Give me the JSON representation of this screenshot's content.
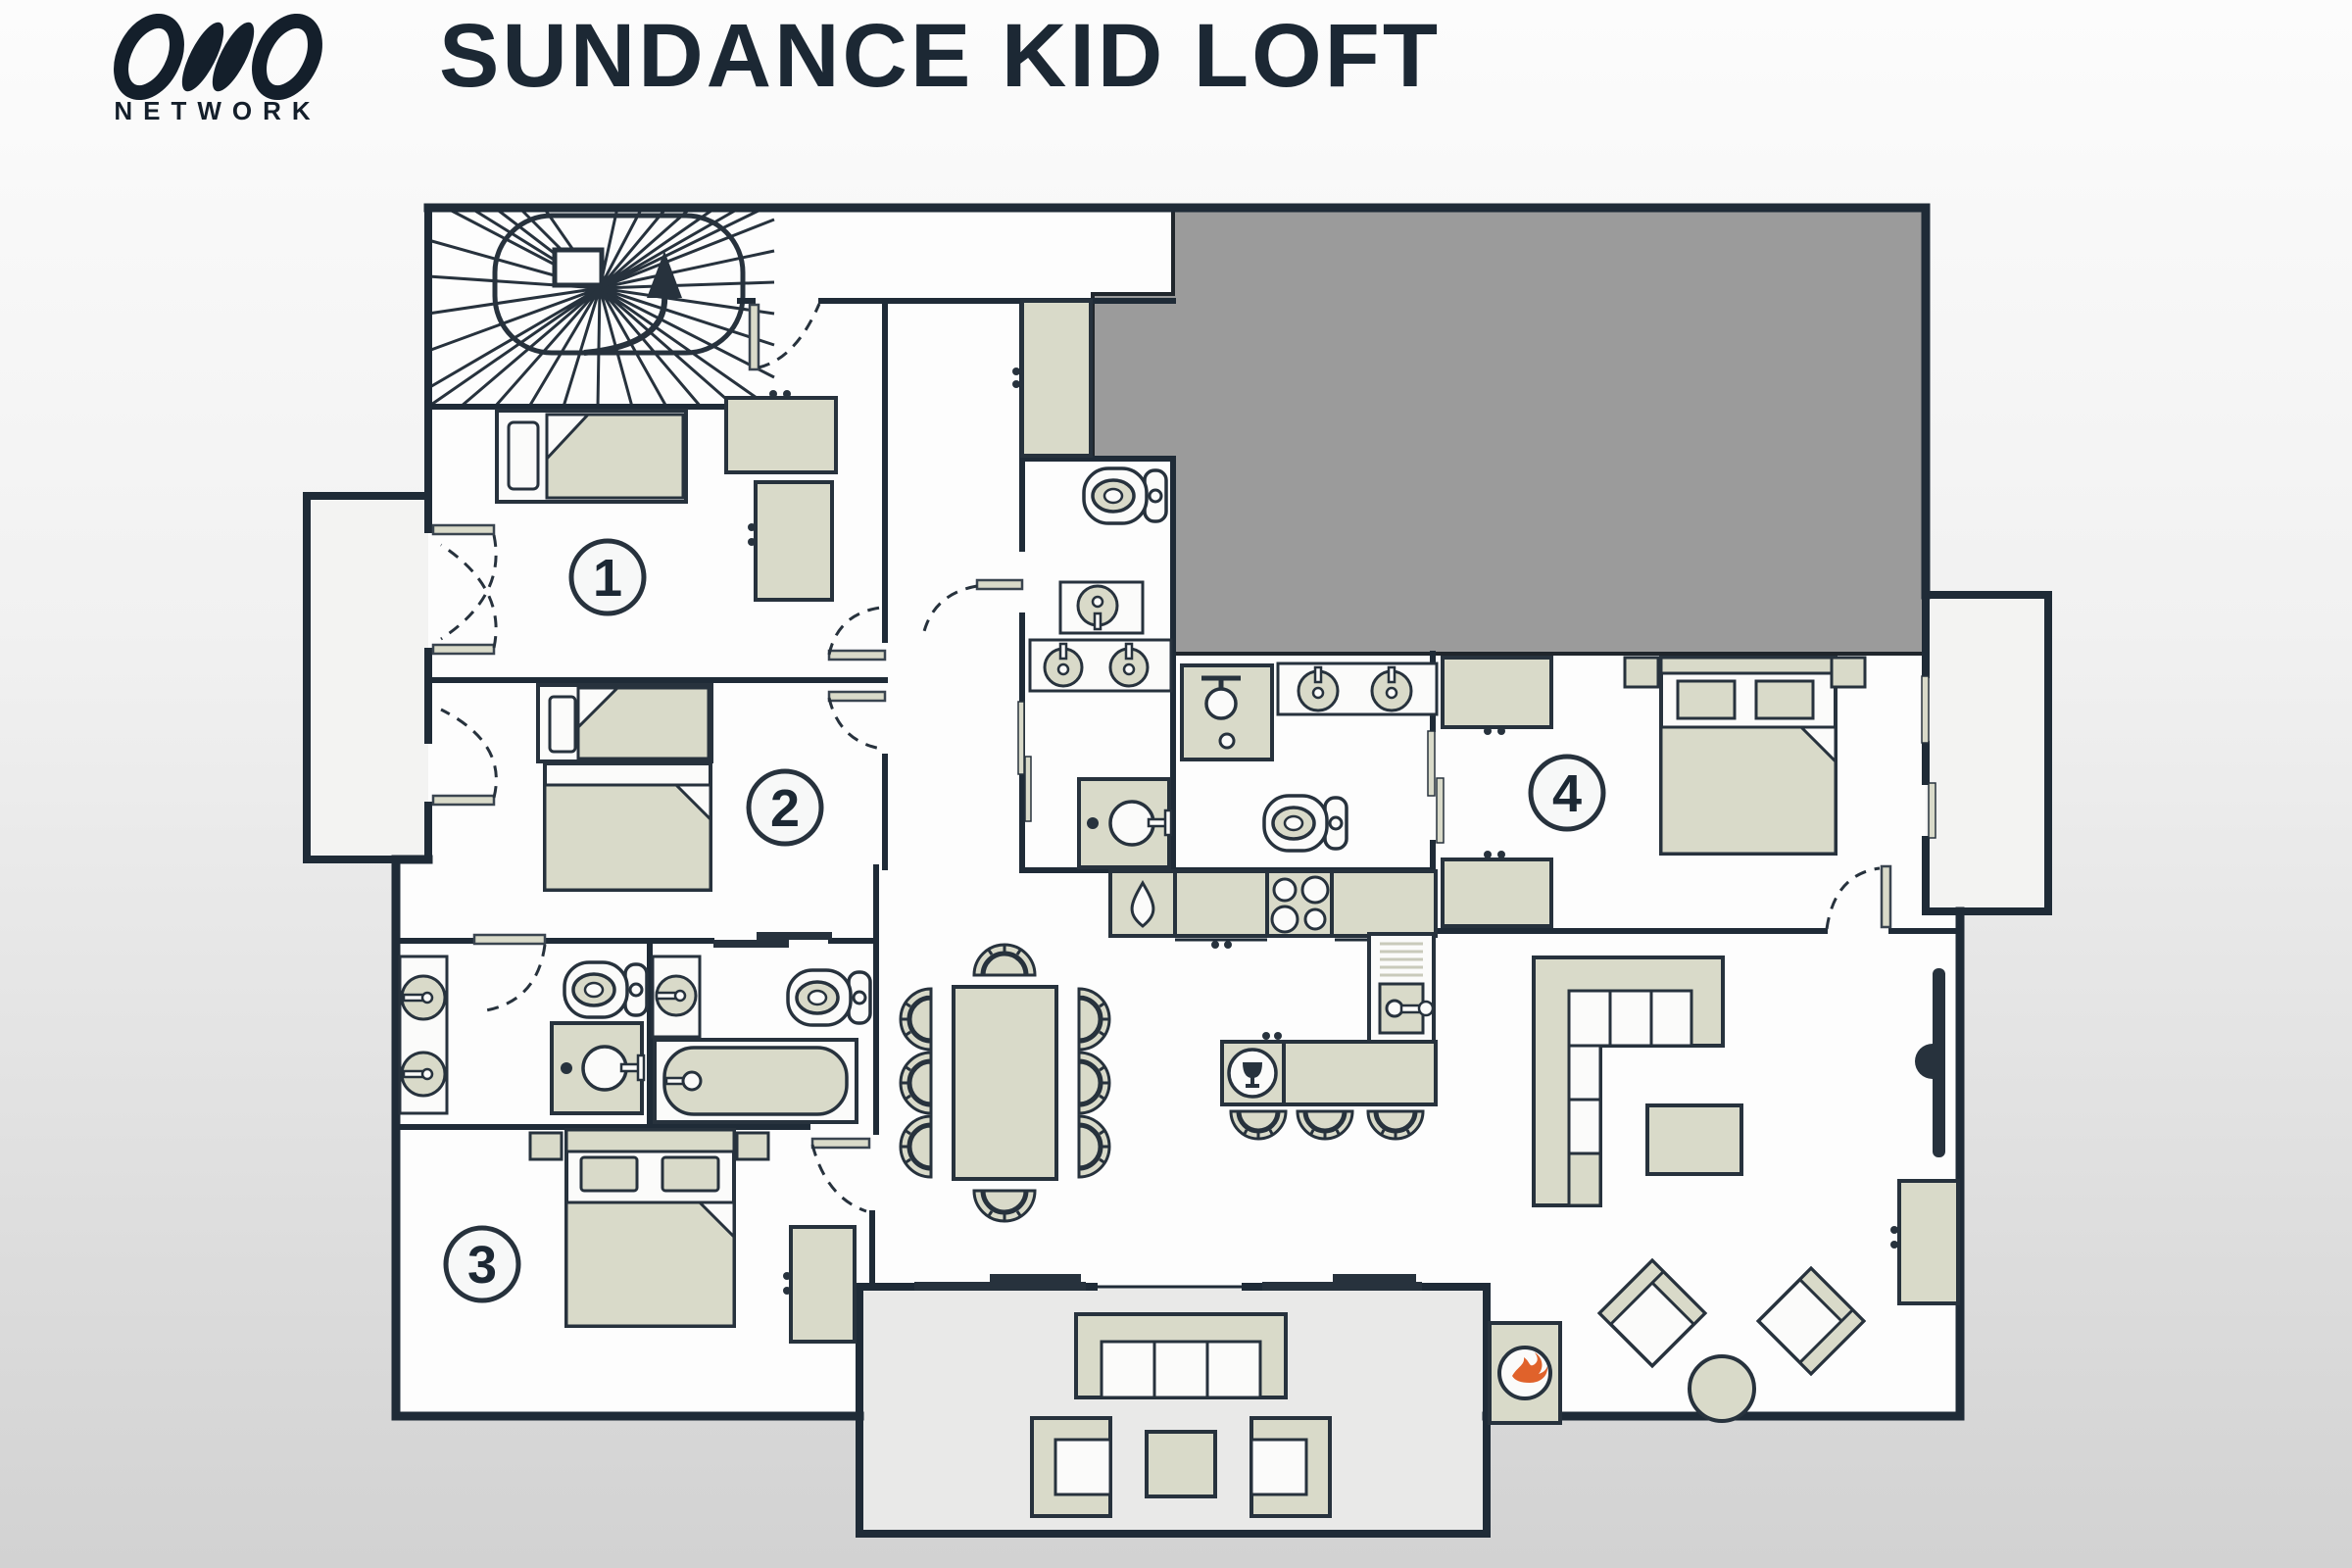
{
  "header": {
    "logo_text": "OVO",
    "logo_subtitle": "NETWORK",
    "title": "SUNDANCE KID LOFT"
  },
  "floor_plan": {
    "rooms": [
      {
        "id": "bedroom-1",
        "number": "1",
        "furniture": [
          "single-bed",
          "wardrobe",
          "wardrobe",
          "balcony-double-door"
        ]
      },
      {
        "id": "bedroom-2",
        "number": "2",
        "furniture": [
          "single-bed",
          "double-bed",
          "balcony-door"
        ]
      },
      {
        "id": "bedroom-3",
        "number": "3",
        "furniture": [
          "double-bed",
          "nightstand",
          "nightstand",
          "wardrobe"
        ]
      },
      {
        "id": "bedroom-4",
        "number": "4",
        "furniture": [
          "double-bed",
          "nightstand",
          "nightstand",
          "wardrobe",
          "wardrobe"
        ]
      }
    ],
    "areas": [
      "spiral-staircase",
      "hallway",
      "corridor",
      "left-balcony",
      "right-balcony",
      "family-bathroom",
      "bathroom-with-tub",
      "wc",
      "shared-shower-room",
      "ensuite-shower-room",
      "kitchen",
      "dining-area",
      "living-area",
      "terrace",
      "roof-void"
    ],
    "fixtures": [
      "toilet",
      "washbasin",
      "double-washbasin",
      "vanity-unit",
      "bathtub",
      "shower",
      "kitchen-sink",
      "hob-4-burners",
      "tall-appliance",
      "dishwasher",
      "kitchen-island",
      "bar-stool",
      "dining-table",
      "dining-chair",
      "corner-sofa",
      "coffee-table",
      "tv",
      "sideboard",
      "armchair",
      "round-side-table",
      "fireplace",
      "outdoor-sofa",
      "outdoor-armchair",
      "outdoor-table"
    ]
  },
  "icons": {
    "fireplace": "flame-icon",
    "kitchen_sink": "water-drop-icon",
    "dishwasher": "wine-glass-icon",
    "staircase_direction": "up-arrow-icon"
  },
  "colors": {
    "wall_dark_navy": "#1f2b37",
    "furniture_beige": "#d9dac9",
    "roof_void_gray": "#9b9b9b",
    "flame_orange": "#e0622b",
    "title_navy": "#1c2834",
    "background_top": "#fcfcfc",
    "background_bottom": "#d2d2d2"
  }
}
